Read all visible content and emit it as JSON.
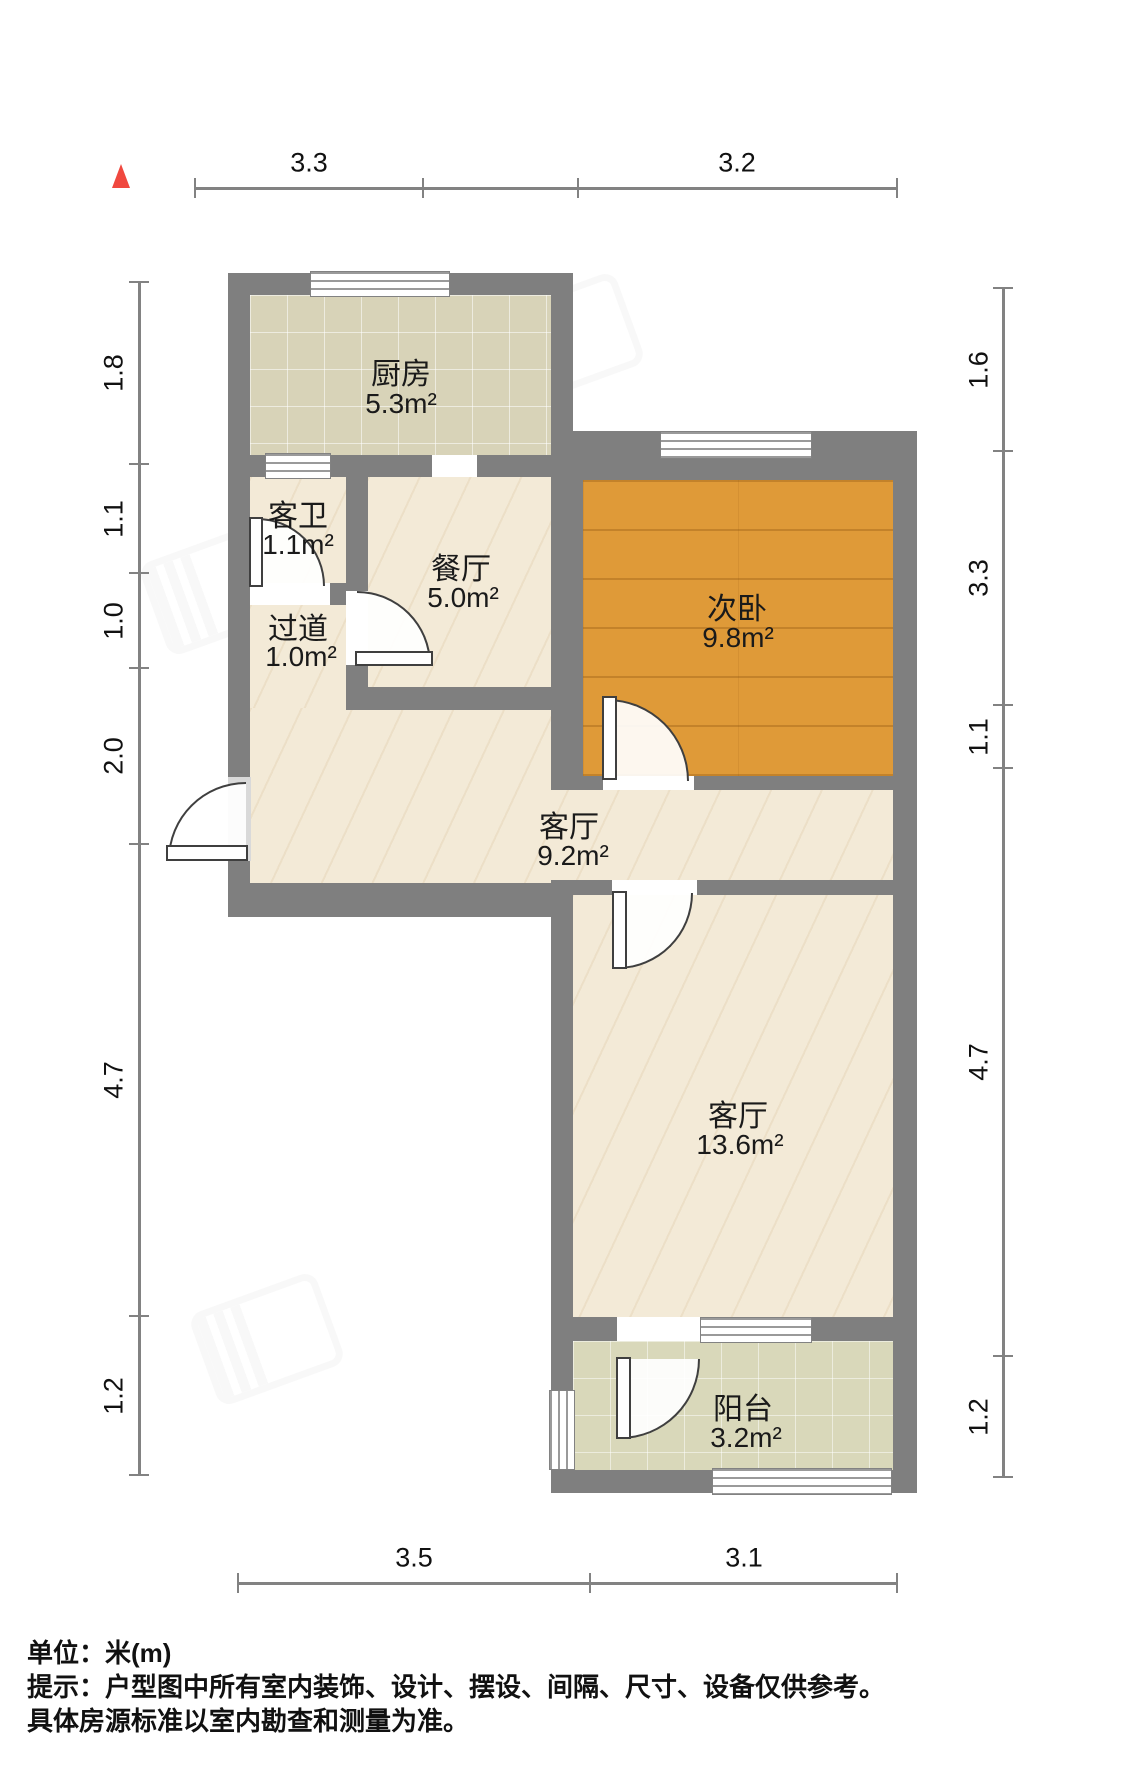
{
  "plan_type": "residential-floor-plan",
  "rooms": {
    "kitchen": {
      "name": "厨房",
      "area": "5.3m²"
    },
    "bathroom": {
      "name": "客卫",
      "area": "1.1m²"
    },
    "dining": {
      "name": "餐厅",
      "area": "5.0m²"
    },
    "hallway": {
      "name": "过道",
      "area": "1.0m²"
    },
    "bedroom": {
      "name": "次卧",
      "area": "9.8m²"
    },
    "living_mid": {
      "name": "客厅",
      "area": "9.2m²"
    },
    "living_lower": {
      "name": "客厅",
      "area": "13.6m²"
    },
    "balcony": {
      "name": "阳台",
      "area": "3.2m²"
    }
  },
  "dimensions": {
    "top": {
      "d1": "3.3",
      "d2": "3.2"
    },
    "bottom": {
      "d1": "3.5",
      "d2": "3.1"
    },
    "left": {
      "d1": "1.8",
      "d2": "1.1",
      "d3": "1.0",
      "d4": "2.0",
      "d5": "4.7",
      "d6": "1.2"
    },
    "right": {
      "d1": "1.6",
      "d2": "3.3",
      "d3": "1.1",
      "d4": "4.7",
      "d5": "1.2"
    }
  },
  "footer": {
    "unit": "单位：米(m)",
    "note_line1": "提示：户型图中所有室内装饰、设计、摆设、间隔、尺寸、设备仅供参考。",
    "note_line2": "具体房源标准以室内勘查和测量为准。"
  },
  "colors": {
    "wall": "#7f7f7f",
    "marble_floor": "#f3ead7",
    "kitchen_floor": "#d8d3b8",
    "wood_floor": "#df9a38",
    "balcony_floor": "#d9d8ba",
    "north_marker": "#f0483f",
    "dim_line": "#828282",
    "text": "#111111"
  }
}
